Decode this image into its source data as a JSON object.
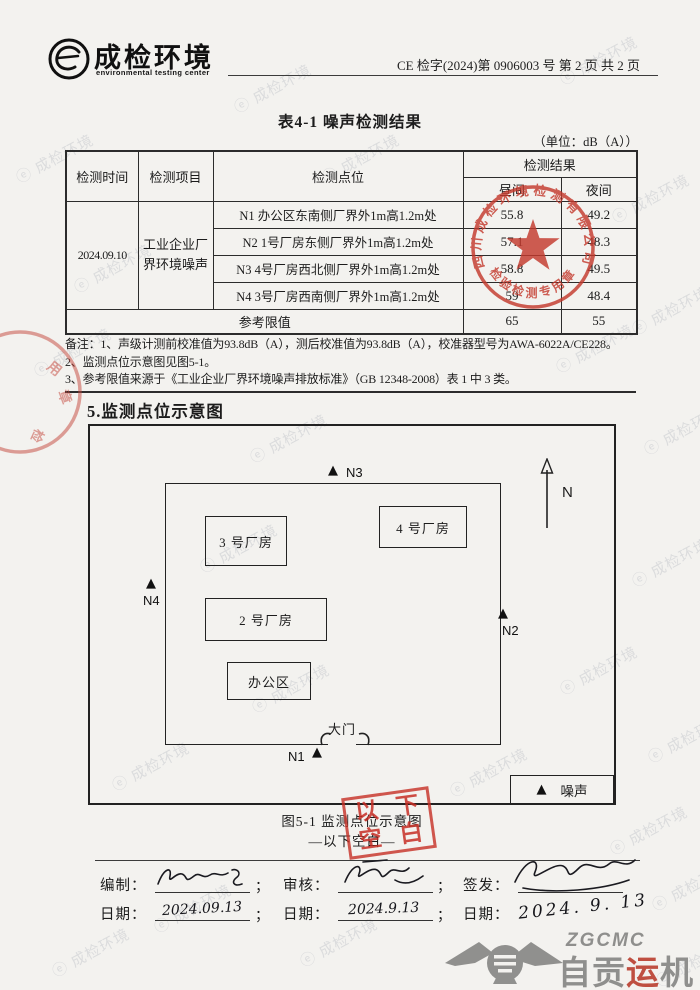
{
  "header": {
    "company_name": "成检环境",
    "company_subtitle": "environmental testing center",
    "doc_number": "CE 检字(2024)第 0906003 号 第 2 页 共 2 页"
  },
  "table": {
    "title": "表4-1 噪声检测结果",
    "unit_note": "（单位：dB（A））",
    "headers": {
      "time": "检测时间",
      "item": "检测项目",
      "point": "检测点位",
      "result": "检测结果",
      "day": "昼间",
      "night": "夜间"
    },
    "time_value": "2024.09.10",
    "item_value": "工业企业厂界环境噪声",
    "rows": [
      {
        "point": "N1 办公区东南侧厂界外1m高1.2m处",
        "day": "55.8",
        "night": "49.2"
      },
      {
        "point": "N2 1号厂房东侧厂界外1m高1.2m处",
        "day": "57.1",
        "night": "48.3"
      },
      {
        "point": "N3 4号厂房西北侧厂界外1m高1.2m处",
        "day": "58.8",
        "night": "49.5"
      },
      {
        "point": "N4 3号厂房西南侧厂界外1m高1.2m处",
        "day": "59",
        "night": "48.4"
      }
    ],
    "limit_label": "参考限值",
    "limit_day": "65",
    "limit_night": "55"
  },
  "notes": [
    "备注：1、声级计测前校准值为93.8dB（A），测后校准值为93.8dB（A），校准器型号为AWA-6022A/CE228。",
    "2、监测点位示意图见图5-1。",
    "3、参考限值来源于《工业企业厂界环境噪声排放标准》（GB 12348-2008）表 1 中 3 类。"
  ],
  "section_title": "5.监测点位示意图",
  "diagram": {
    "building3": "3 号厂房",
    "building4": "4 号厂房",
    "building2": "2 号厂房",
    "office": "办公区",
    "gate_label": "大门",
    "north_label": "N",
    "point_n1": "N1",
    "point_n2": "N2",
    "point_n3": "N3",
    "point_n4": "N4",
    "marker": "▲",
    "legend_label": "噪声",
    "caption": "图5-1 监测点位示意图",
    "blank_note": "—以下空白—"
  },
  "stamps": {
    "seal_top_text": "四川成检环境检测有限公司",
    "seal_bottom_text": "检验检测专用章",
    "blank_chars": [
      "以",
      "下",
      "空",
      "白"
    ]
  },
  "signatures": {
    "prepared_label": "编制：",
    "reviewed_label": "审核：",
    "issued_label": "签发：",
    "date_label": "日期：",
    "prepared_date": "2024.09.13",
    "reviewed_date": "2024.9.13",
    "issued_date": "2024. 9. 13",
    "separator": "；"
  },
  "footer_logo": {
    "abbr": "ZGCMC",
    "name_part1": "自贡",
    "name_accent": "运",
    "name_part3": "机"
  },
  "watermark": "成检环境"
}
